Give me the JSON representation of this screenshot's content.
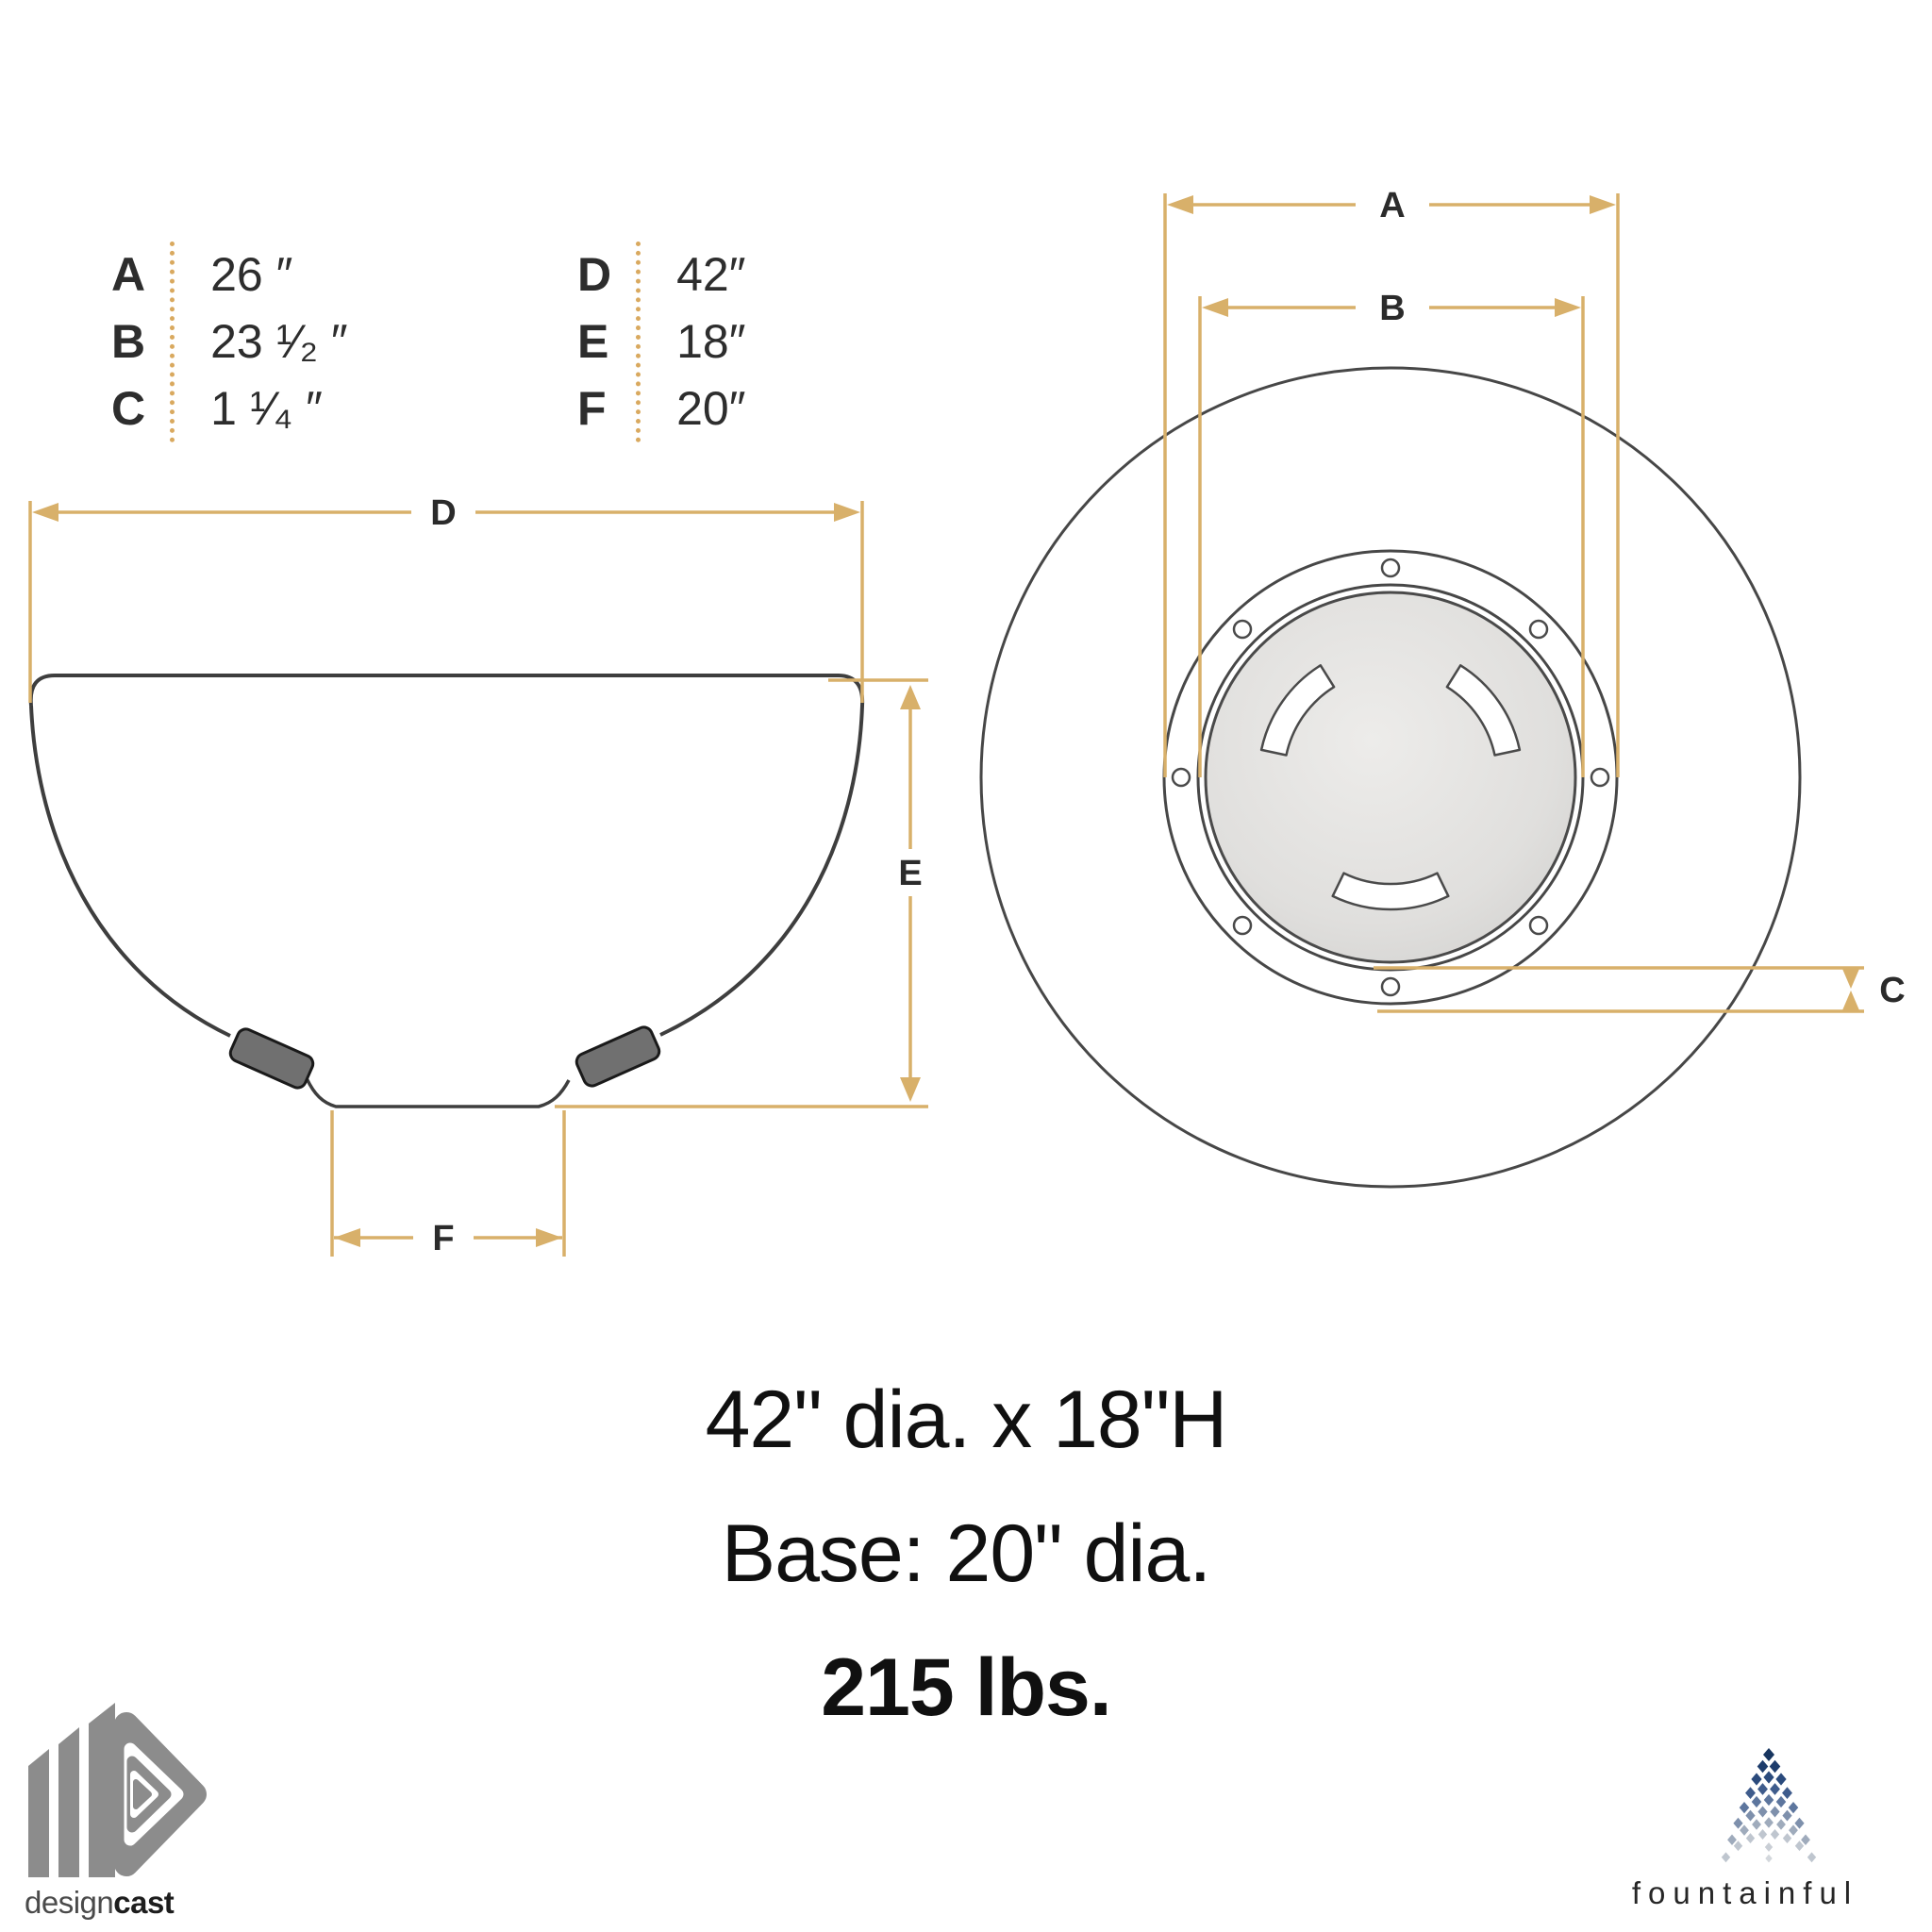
{
  "legend": {
    "left": [
      {
        "letter": "A",
        "value": "26 ″"
      },
      {
        "letter": "B",
        "value": "23 ¹⁄₂ ″"
      },
      {
        "letter": "C",
        "value": "1 ¹⁄₄ ″"
      }
    ],
    "right": [
      {
        "letter": "D",
        "value": "42″"
      },
      {
        "letter": "E",
        "value": "18″"
      },
      {
        "letter": "F",
        "value": "20″"
      }
    ]
  },
  "side_view": {
    "labels": {
      "d": "D",
      "e": "E",
      "f": "F"
    }
  },
  "top_view": {
    "labels": {
      "a": "A",
      "b": "B",
      "c": "C"
    }
  },
  "specs": {
    "dimensions": "42\" dia. x 18\"H",
    "base": "Base: 20\" dia.",
    "weight": "215 lbs."
  },
  "branding": {
    "designcast": {
      "word_light": "design",
      "word_bold": "cast"
    },
    "fountainful": {
      "word": "fountainful"
    }
  },
  "colors": {
    "dimension_gold": "#d8b06a",
    "drawing_line": "#424242",
    "logo_gray": "#8c8c8c",
    "fountain_navy": "#1d3c6c"
  }
}
